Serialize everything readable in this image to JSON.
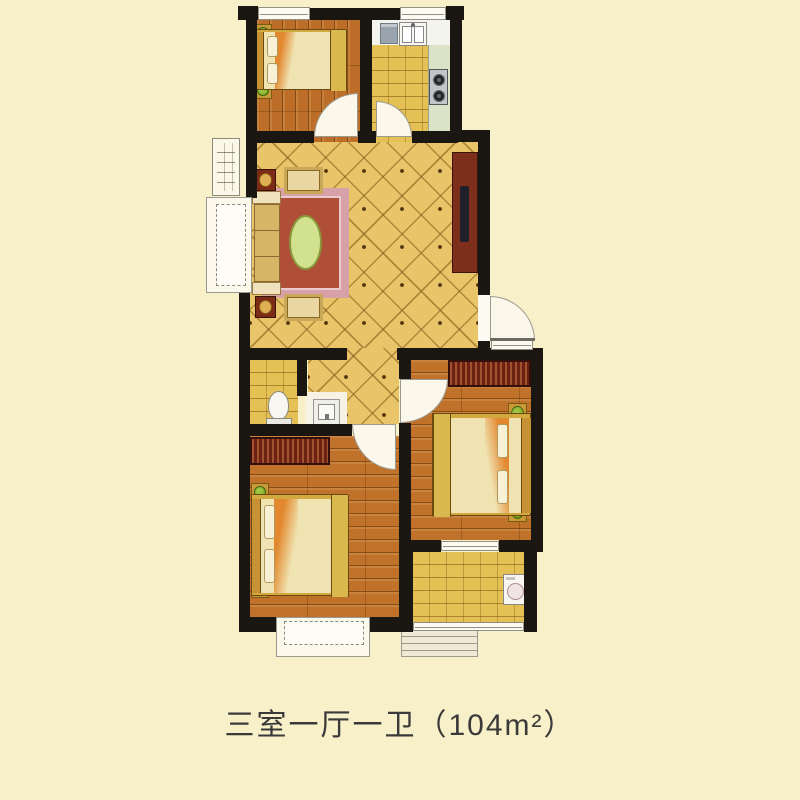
{
  "caption": {
    "text": "三室一厅一卫（104m²）",
    "layout_label": "三室一厅一卫",
    "area_value": "104",
    "area_unit": "m²"
  },
  "colors": {
    "bg": "#F8F0C9",
    "wall": "#1A1611",
    "tile": "#E9C469",
    "wood": "#C0722B",
    "wood2": "#BC6E28",
    "brick": "#E4C055",
    "window-fill": "#FDFBF1",
    "door-fill": "#FBF7EA",
    "line": "#8F8F85",
    "arc": "#9A9A90",
    "counter": "#F3F4EE",
    "counter-green": "#DAE3C7",
    "appliance-gray": "#9AA4AE",
    "stove": "#C2C6CC",
    "burner": "#26262A",
    "wardrobe": "#6B2212",
    "bed-frame": "#D3A93F",
    "mattress": "#F0E3B2",
    "pillow": "#F8F1D6",
    "accent": "#E2892F",
    "plant": "#86B42C",
    "pot": "#C79A36",
    "sofa": "#E3C98F",
    "cushion": "#D6B567",
    "ottoman": "#E9D6A2",
    "side-table": "#7B2B16",
    "lamp": "#DFAF54",
    "carpet-border": "#D8A1A9",
    "carpet": "#AF4F38",
    "oval-table": "#D2E18E",
    "tv-cabinet": "#7D2F1B",
    "tv": "#20202B",
    "fixture": "#F7F6F0",
    "text": "#3A3A3A"
  },
  "plan": {
    "rooms": [
      "bedroom-top-left",
      "kitchen",
      "living-room",
      "bathroom",
      "hallway",
      "bedroom-bottom-left",
      "bedroom-bottom-right",
      "balcony"
    ],
    "furniture": [
      "double-bed",
      "nightstand-plant",
      "wardrobe",
      "sofa",
      "armchair",
      "side-lamp-table",
      "rug",
      "oval-coffee-table",
      "tv-cabinet",
      "kitchen-sink",
      "refrigerator",
      "gas-stove",
      "toilet",
      "wash-basin",
      "washing-machine",
      "entry-steps",
      "bay-window",
      "swing-door",
      "window"
    ]
  }
}
